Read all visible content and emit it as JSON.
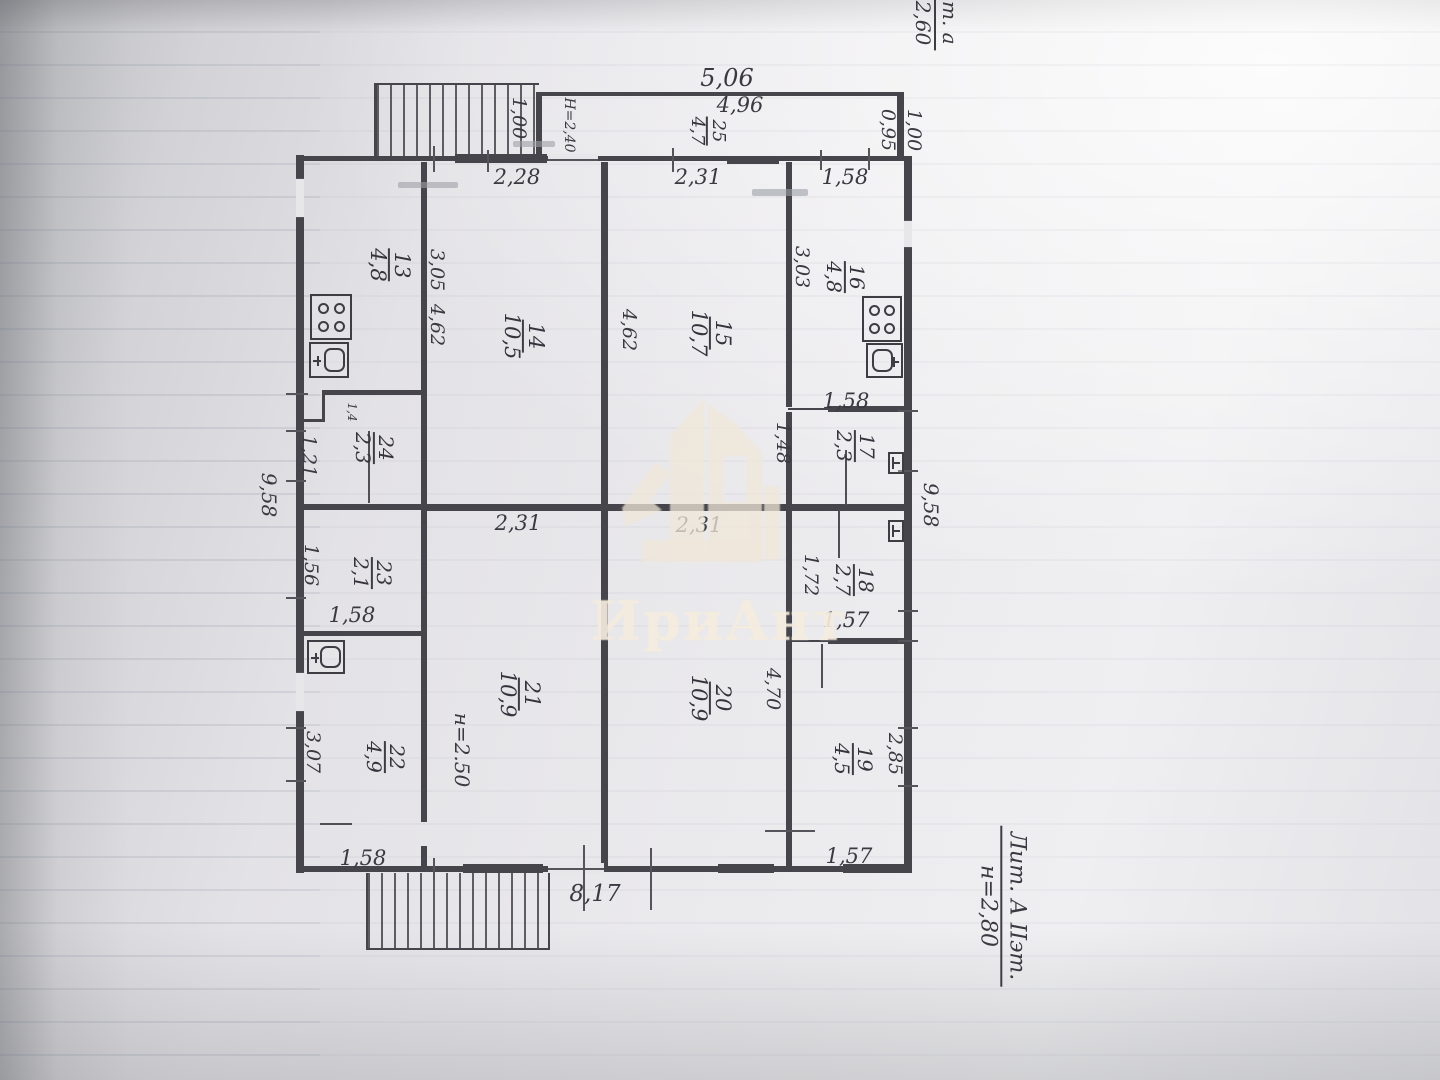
{
  "document_type": "floor-plan-photo",
  "watermark": {
    "text": "ИриАнт"
  },
  "notes": {
    "top_left": {
      "line1": "Лит. а",
      "line2": "н=2,60"
    },
    "bottom_right": {
      "line1": "Лит. А IIэт.",
      "line2": "н=2,80"
    }
  },
  "floor_plan": {
    "rooms": [
      {
        "number": "13",
        "area": "4,8",
        "x": 389,
        "y": 265,
        "fs": 21
      },
      {
        "number": "14",
        "area": "10,5",
        "x": 523,
        "y": 336,
        "fs": 21
      },
      {
        "number": "15",
        "area": "10,7",
        "x": 710,
        "y": 333,
        "fs": 21
      },
      {
        "number": "16",
        "area": "4,8",
        "x": 845,
        "y": 277,
        "fs": 20
      },
      {
        "number": "17",
        "area": "2,3",
        "x": 855,
        "y": 446,
        "fs": 20
      },
      {
        "number": "18",
        "area": "2,7",
        "x": 854,
        "y": 580,
        "fs": 20
      },
      {
        "number": "19",
        "area": "4,5",
        "x": 853,
        "y": 759,
        "fs": 20
      },
      {
        "number": "20",
        "area": "10,9",
        "x": 710,
        "y": 698,
        "fs": 21
      },
      {
        "number": "21",
        "area": "10,9",
        "x": 519,
        "y": 694,
        "fs": 21
      },
      {
        "number": "22",
        "area": "4,9",
        "x": 385,
        "y": 757,
        "fs": 20
      },
      {
        "number": "23",
        "area": "2,1",
        "x": 372,
        "y": 573,
        "fs": 20
      },
      {
        "number": "24",
        "area": "2,3",
        "x": 374,
        "y": 448,
        "fs": 20
      },
      {
        "number": "25",
        "area": "4,7",
        "x": 707,
        "y": 131,
        "fs": 18
      }
    ],
    "dims_h": [
      {
        "t": "5,06",
        "x": 727,
        "y": 78,
        "fs": 24
      },
      {
        "t": "4,96",
        "x": 740,
        "y": 105,
        "fs": 21
      },
      {
        "t": "2,28",
        "x": 517,
        "y": 177,
        "fs": 21
      },
      {
        "t": "2,31",
        "x": 698,
        "y": 177,
        "fs": 21
      },
      {
        "t": "1,58",
        "x": 845,
        "y": 177,
        "fs": 21
      },
      {
        "t": "1,58",
        "x": 846,
        "y": 401,
        "fs": 21
      },
      {
        "t": "1,57",
        "x": 846,
        "y": 620,
        "fs": 21
      },
      {
        "t": "1,57",
        "x": 849,
        "y": 856,
        "fs": 21
      },
      {
        "t": "2,31",
        "x": 518,
        "y": 523,
        "fs": 21
      },
      {
        "t": "2,31",
        "x": 699,
        "y": 525,
        "fs": 21
      },
      {
        "t": "1,58",
        "x": 352,
        "y": 615,
        "fs": 21
      },
      {
        "t": "1,58",
        "x": 363,
        "y": 858,
        "fs": 21
      },
      {
        "t": "8,17",
        "x": 595,
        "y": 894,
        "fs": 23
      }
    ],
    "dims_v": [
      {
        "t": "1,00",
        "x": 519,
        "y": 118,
        "fs": 19
      },
      {
        "t": "Н=2,40",
        "x": 569,
        "y": 125,
        "fs": 14
      },
      {
        "t": "0,95",
        "x": 888,
        "y": 130,
        "fs": 19
      },
      {
        "t": "1,00",
        "x": 914,
        "y": 130,
        "fs": 19
      },
      {
        "t": "3,05",
        "x": 437,
        "y": 270,
        "fs": 19
      },
      {
        "t": "4,62",
        "x": 437,
        "y": 325,
        "fs": 19
      },
      {
        "t": "4,62",
        "x": 629,
        "y": 330,
        "fs": 19
      },
      {
        "t": "3,03",
        "x": 802,
        "y": 267,
        "fs": 19
      },
      {
        "t": "1,48",
        "x": 783,
        "y": 443,
        "fs": 19
      },
      {
        "t": "1,72",
        "x": 811,
        "y": 575,
        "fs": 19
      },
      {
        "t": "4,70",
        "x": 773,
        "y": 689,
        "fs": 19
      },
      {
        "t": "2,85",
        "x": 895,
        "y": 754,
        "fs": 19
      },
      {
        "t": "н=2.50",
        "x": 462,
        "y": 750,
        "fs": 20
      },
      {
        "t": "3,07",
        "x": 313,
        "y": 752,
        "fs": 19
      },
      {
        "t": "1,56",
        "x": 311,
        "y": 565,
        "fs": 19
      },
      {
        "t": "1,21",
        "x": 309,
        "y": 456,
        "fs": 19
      },
      {
        "t": "1,4",
        "x": 352,
        "y": 412,
        "fs": 12
      },
      {
        "t": "9,58",
        "x": 269,
        "y": 495,
        "fs": 20
      },
      {
        "t": "9,58",
        "x": 931,
        "y": 505,
        "fs": 20
      }
    ],
    "icons": [
      {
        "type": "stove",
        "x": 310,
        "y": 294,
        "w": 42,
        "h": 46
      },
      {
        "type": "sink",
        "x": 309,
        "y": 342,
        "w": 40,
        "h": 36,
        "tap": "left"
      },
      {
        "type": "stove",
        "x": 862,
        "y": 296,
        "w": 40,
        "h": 46
      },
      {
        "type": "sink",
        "x": 866,
        "y": 343,
        "w": 37,
        "h": 35,
        "tap": "right"
      },
      {
        "type": "toilet",
        "x": 888,
        "y": 452,
        "w": 16,
        "h": 22
      },
      {
        "type": "toilet",
        "x": 888,
        "y": 520,
        "w": 16,
        "h": 22
      },
      {
        "type": "sink",
        "x": 307,
        "y": 640,
        "w": 38,
        "h": 34,
        "tap": "left"
      }
    ]
  }
}
